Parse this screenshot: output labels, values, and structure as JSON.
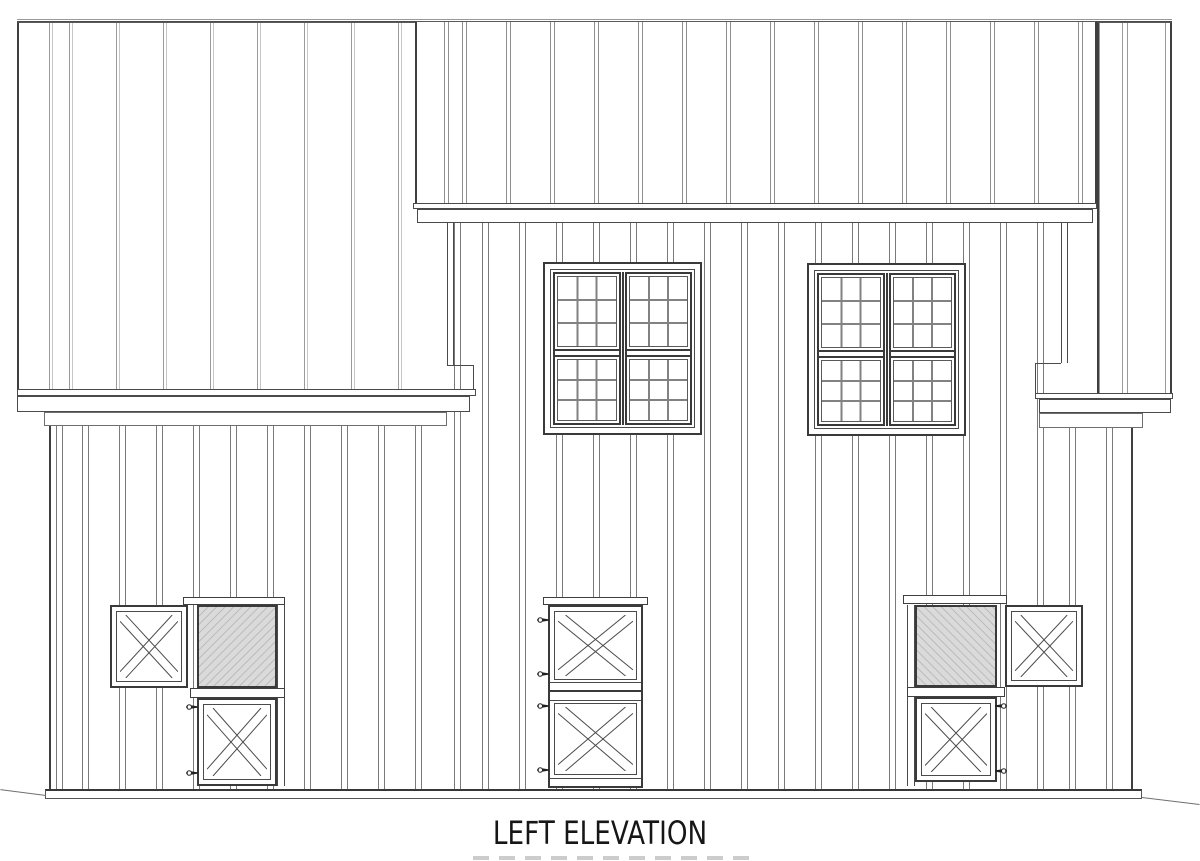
{
  "title": {
    "text": "LEFT ELEVATION"
  },
  "drawing": {
    "type": "architectural-elevation",
    "view": "left",
    "subject": "barn with board-and-batten siding",
    "upper_gable_sections": 3,
    "windows_count": 2,
    "window_style": "double 18-lite grid sashes with meeting rail",
    "dutch_doors_count": 3,
    "open_door_leaves_count": 2,
    "hatched_openings_count": 2,
    "hinges_per_closed_leaf": 2
  },
  "colors": {
    "background": "#ffffff",
    "line_strong": "#3a3a3a",
    "line_medium": "#6f6f6f",
    "line_light": "#9b9b9b",
    "hatch_fill": "#dadada",
    "hatch_line": "#bdbdbd",
    "title": "#161616"
  }
}
